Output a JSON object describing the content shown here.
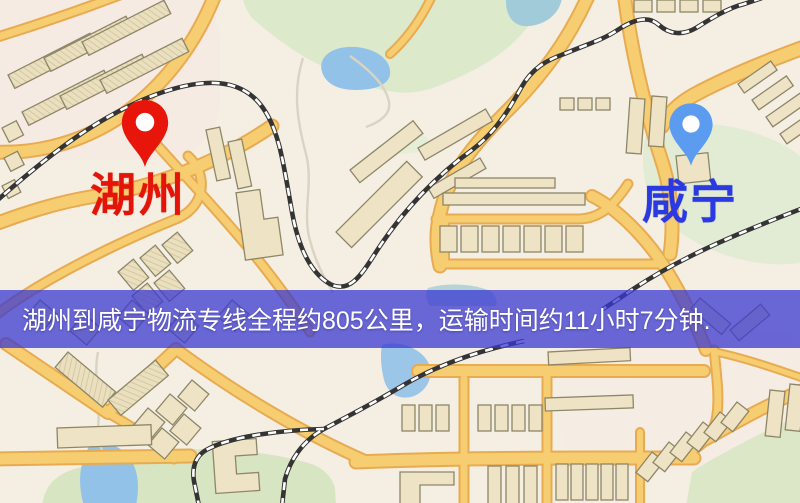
{
  "map": {
    "origin": {
      "label": "湖州",
      "pin_color": "#e8150b",
      "label_color": "#e31408"
    },
    "destination": {
      "label": "咸宁",
      "pin_color": "#5b9bf0",
      "label_color": "#2b3ae0"
    },
    "banner": {
      "text": "湖州到咸宁物流专线全程约805公里，运输时间约11小时7分钟.",
      "background_color": "#3a38d0",
      "text_color": "#ffffff",
      "distance_km": "805",
      "duration": "11小时7分钟"
    },
    "palette": {
      "background": "#f5efe3",
      "road": "#f6cd70",
      "road_edge": "#e8ab52",
      "building": "#eee3c4",
      "park": "#dde9cb",
      "water": "#92c2e8",
      "railway": "#343434"
    }
  }
}
